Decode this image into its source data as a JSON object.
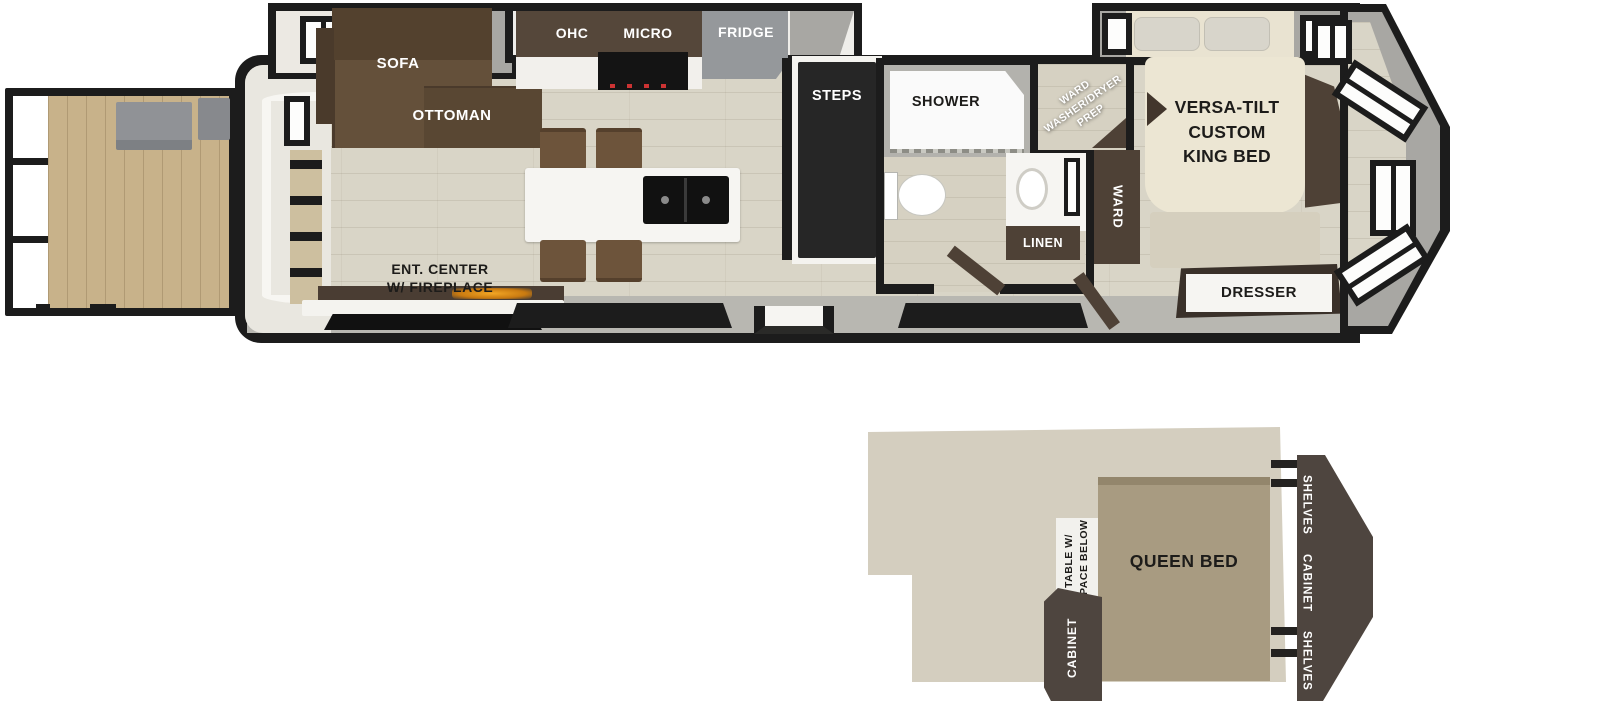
{
  "colors": {
    "wall": "#1c1c1c",
    "deck_wood": "#c8b28a",
    "interior_floor": "#d9d5c7",
    "sofa_brown": "#5e4b39",
    "cabinet_dark_brown": "#4e4136",
    "fridge_grey": "#95989b",
    "steps_charcoal": "#262626",
    "bed_cream": "#ece6d3",
    "loft_floor": "#d4cebf",
    "queen_bed_tan": "#a89b81",
    "loft_unit_brown": "#4e453f",
    "fireplace_accent": "#e8920a"
  },
  "plan": {
    "living": {
      "sofa": "SOFA",
      "ottoman": "OTTOMAN",
      "ent_center": "ENT. CENTER\nW/ FIREPLACE"
    },
    "kitchen": {
      "ohc": "OHC",
      "micro": "MICRO",
      "fridge": "FRIDGE"
    },
    "steps_label": "STEPS",
    "bath": {
      "shower": "SHOWER",
      "washer_dryer": "WARD\nWASHER/DRYER\nPREP",
      "linen": "LINEN"
    },
    "bedroom": {
      "king_bed": "VERSA-TILT\nCUSTOM\nKING BED",
      "ward": "WARD",
      "dresser": "DRESSER"
    }
  },
  "loft": {
    "queen_bed": "QUEEN BED",
    "table": "TABLE W/\nSPACE BELOW",
    "cabinet_left": "CABINET",
    "shelves_top": "SHELVES",
    "cabinet_right": "CABINET",
    "shelves_bottom": "SHELVES"
  }
}
